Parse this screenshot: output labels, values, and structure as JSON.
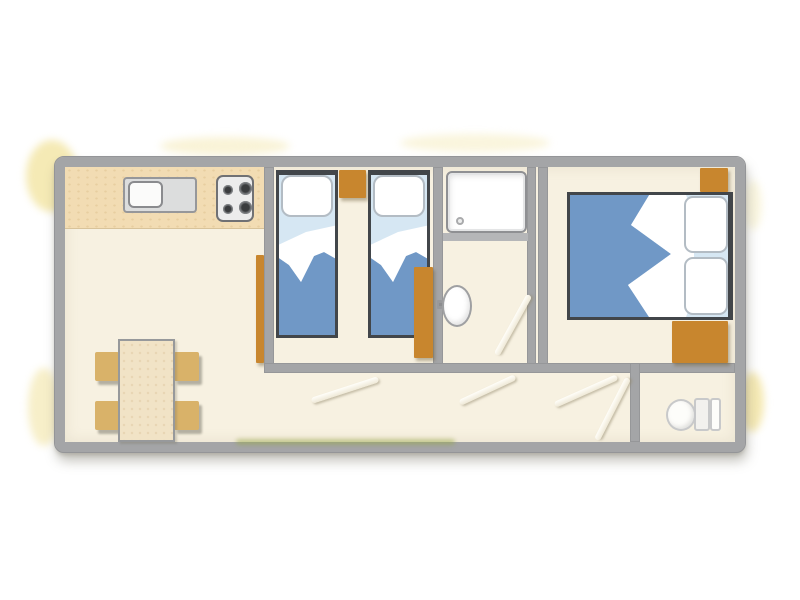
{
  "floorplan": {
    "kind": "mobile-home-floor-plan",
    "rooms": [
      {
        "id": "living-kitchen",
        "furniture": [
          "kitchen-counter",
          "sink",
          "stove-4-burners",
          "dining-table",
          "chair",
          "chair",
          "chair",
          "chair",
          "shelf"
        ]
      },
      {
        "id": "twin-bedroom",
        "furniture": [
          "single-bed",
          "single-bed",
          "nightstand",
          "wardrobe"
        ]
      },
      {
        "id": "shower-room",
        "furniture": [
          "shower-tray",
          "washbasin"
        ]
      },
      {
        "id": "master-bedroom",
        "furniture": [
          "double-bed",
          "wardrobe",
          "wardrobe"
        ]
      },
      {
        "id": "wc",
        "furniture": [
          "toilet"
        ]
      }
    ],
    "door_swing_marks": 5
  },
  "palette": {
    "wall": "#a4a5a7",
    "floor": "#f7f1e1",
    "counter": "#f2dcb3",
    "brown": "#c8862e",
    "chair": "#d9b269",
    "table": "#f1e3c6",
    "blanket": "#7098c6",
    "sheet": "#d6e7f3",
    "grass": "#98a846",
    "smudge": "#f3e6aa"
  }
}
